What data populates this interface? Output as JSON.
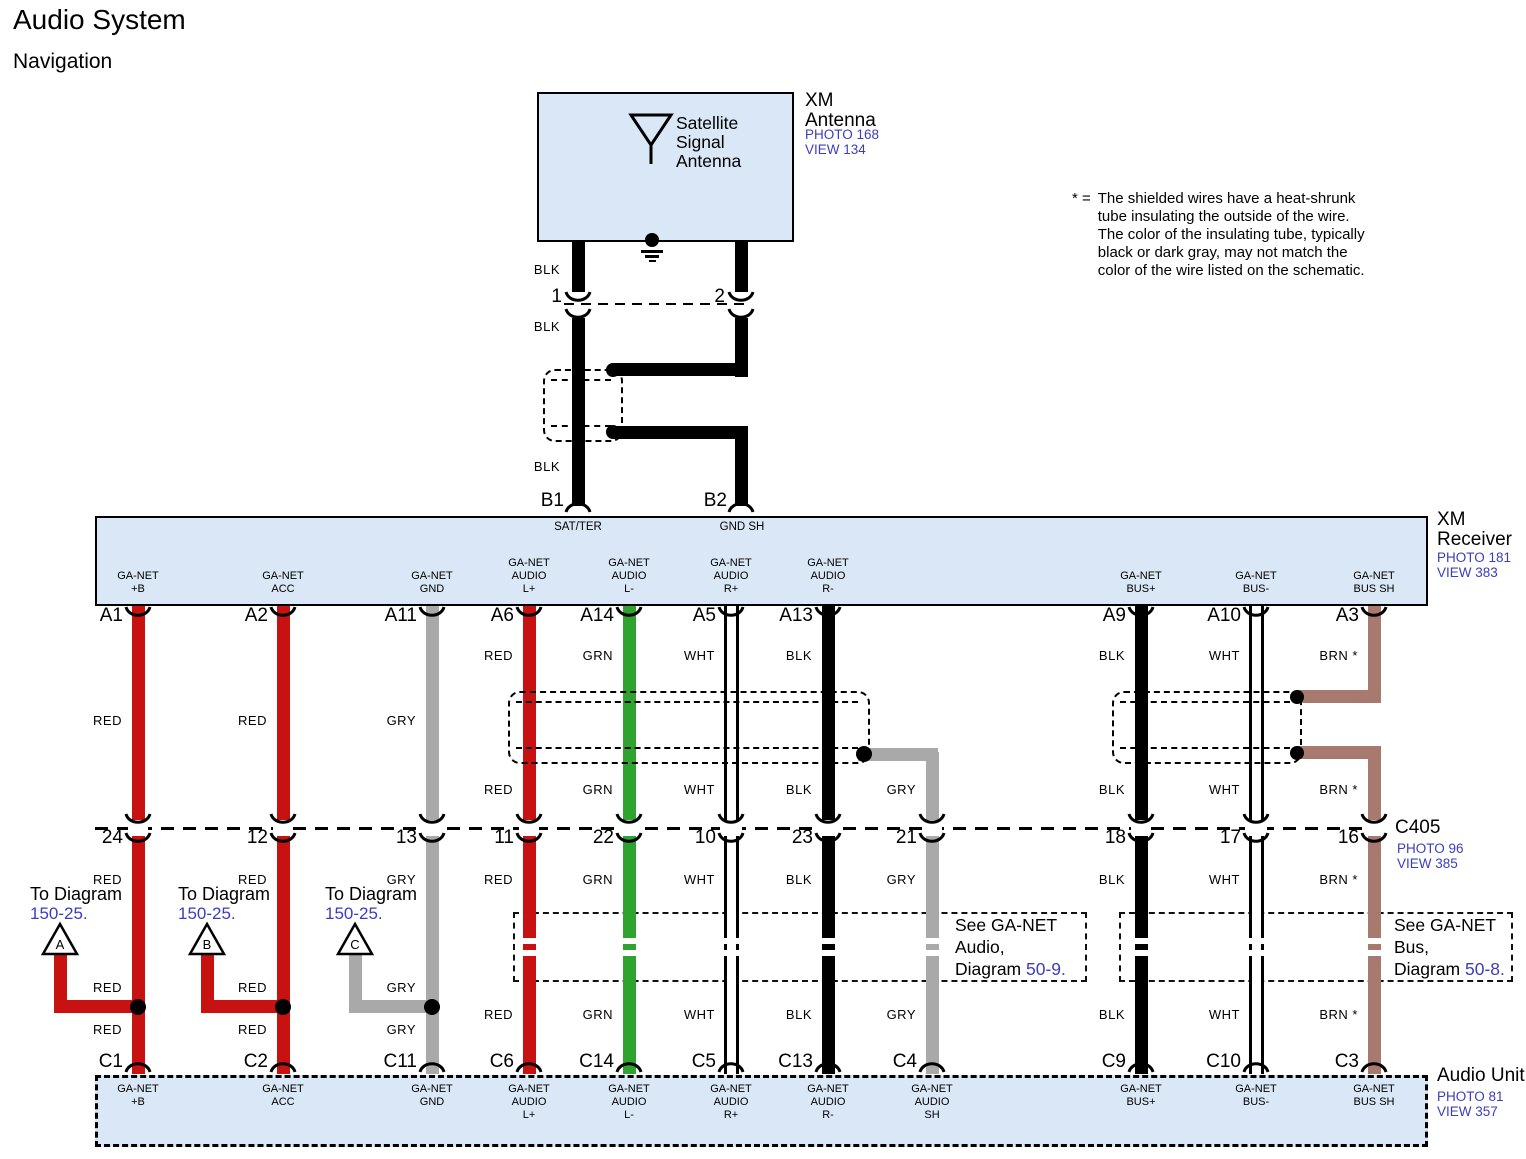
{
  "title": "Audio System",
  "subtitle": "Navigation",
  "note": {
    "prefix": "* =",
    "lines": [
      "The shielded wires have a heat-shrunk",
      "tube insulating the outside of the wire.",
      "The color of the insulating tube, typically",
      "black or dark gray, may not match the",
      "color of the wire listed on the schematic."
    ]
  },
  "palette": {
    "red": "#c81111",
    "green": "#2fa32f",
    "gray": "#a9a9a9",
    "black": "#000000",
    "white": "#ffffff",
    "brown": "#a7796f",
    "box_fill": "#d9e7f6",
    "ref_blue": "#3c3cc0"
  },
  "antenna": {
    "box_label": [
      "Satellite",
      "Signal",
      "Antenna"
    ],
    "title_lines": [
      "XM",
      "Antenna"
    ],
    "photo": "PHOTO 168",
    "view": "VIEW 134",
    "pin1": "1",
    "pin2": "2",
    "b1": "B1",
    "b2": "B2",
    "wire_label_1": "BLK",
    "wire_label_2": "BLK",
    "wire_label_3": "BLK"
  },
  "receiver": {
    "title_lines": [
      "XM",
      "Receiver"
    ],
    "photo": "PHOTO 181",
    "view": "VIEW 383",
    "sat_pin": "SAT/TER",
    "gnd_pin": "GND SH"
  },
  "c405": {
    "name": "C405",
    "photo": "PHOTO 96",
    "view": "VIEW 385"
  },
  "audio_unit": {
    "title": "Audio Unit",
    "photo": "PHOTO 81",
    "view": "VIEW 357"
  },
  "see_audio": {
    "line1": "See GA-NET",
    "line2": "Audio,",
    "line3_word": "Diagram",
    "line3_ref": "50-9."
  },
  "see_bus": {
    "line1": "See GA-NET",
    "line2": "Bus,",
    "line3_word": "Diagram",
    "line3_ref": "50-8."
  },
  "branches": [
    {
      "text": "To Diagram",
      "ref": "150-25.",
      "letter": "A",
      "text_x": 30,
      "tri_x": 60,
      "col_x": 138,
      "wire_color": "red",
      "labels": [
        {
          "t": "RED",
          "y": 988
        },
        {
          "t": "RED",
          "y": 1030
        }
      ]
    },
    {
      "text": "To Diagram",
      "ref": "150-25.",
      "letter": "B",
      "text_x": 178,
      "tri_x": 207,
      "col_x": 283,
      "wire_color": "red",
      "labels": [
        {
          "t": "RED",
          "y": 988
        },
        {
          "t": "RED",
          "y": 1030
        }
      ]
    },
    {
      "text": "To Diagram",
      "ref": "150-25.",
      "letter": "C",
      "text_x": 325,
      "tri_x": 355,
      "col_x": 432,
      "wire_color": "gray",
      "labels": [
        {
          "t": "GRY",
          "y": 988
        },
        {
          "t": "GRY",
          "y": 1030
        }
      ]
    }
  ],
  "columns": [
    {
      "x": 138,
      "color": "red",
      "kind": "full",
      "gaps": false,
      "a": "A1",
      "m": "24",
      "c": "C1",
      "receiver_pin": [
        "GA-NET",
        "+B"
      ],
      "unit_pin": [
        "GA-NET",
        "+B"
      ],
      "labels": [
        {
          "t": "RED",
          "y": 721
        },
        {
          "t": "RED",
          "y": 880
        }
      ]
    },
    {
      "x": 283,
      "color": "red",
      "kind": "full",
      "gaps": false,
      "a": "A2",
      "m": "12",
      "c": "C2",
      "receiver_pin": [
        "GA-NET",
        "ACC"
      ],
      "unit_pin": [
        "GA-NET",
        "ACC"
      ],
      "labels": [
        {
          "t": "RED",
          "y": 721
        },
        {
          "t": "RED",
          "y": 880
        }
      ]
    },
    {
      "x": 432,
      "color": "gray",
      "kind": "full",
      "gaps": false,
      "a": "A11",
      "m": "13",
      "c": "C11",
      "receiver_pin": [
        "GA-NET",
        "GND"
      ],
      "unit_pin": [
        "GA-NET",
        "GND"
      ],
      "labels": [
        {
          "t": "GRY",
          "y": 721
        },
        {
          "t": "GRY",
          "y": 880
        }
      ]
    },
    {
      "x": 529,
      "color": "red",
      "kind": "full",
      "gaps": true,
      "a": "A6",
      "m": "11",
      "c": "C6",
      "receiver_pin": [
        "GA-NET",
        "AUDIO",
        "L+"
      ],
      "unit_pin": [
        "GA-NET",
        "AUDIO",
        "L+"
      ],
      "labels": [
        {
          "t": "RED",
          "y": 656
        },
        {
          "t": "RED",
          "y": 790
        },
        {
          "t": "RED",
          "y": 880
        },
        {
          "t": "RED",
          "y": 1015
        }
      ]
    },
    {
      "x": 629,
      "color": "green",
      "kind": "full",
      "gaps": true,
      "a": "A14",
      "m": "22",
      "c": "C14",
      "receiver_pin": [
        "GA-NET",
        "AUDIO",
        "L-"
      ],
      "unit_pin": [
        "GA-NET",
        "AUDIO",
        "L-"
      ],
      "labels": [
        {
          "t": "GRN",
          "y": 656
        },
        {
          "t": "GRN",
          "y": 790
        },
        {
          "t": "GRN",
          "y": 880
        },
        {
          "t": "GRN",
          "y": 1015
        }
      ]
    },
    {
      "x": 731,
      "color": "white",
      "kind": "full",
      "gaps": true,
      "a": "A5",
      "m": "10",
      "c": "C5",
      "receiver_pin": [
        "GA-NET",
        "AUDIO",
        "R+"
      ],
      "unit_pin": [
        "GA-NET",
        "AUDIO",
        "R+"
      ],
      "labels": [
        {
          "t": "WHT",
          "y": 656
        },
        {
          "t": "WHT",
          "y": 790
        },
        {
          "t": "WHT",
          "y": 880
        },
        {
          "t": "WHT",
          "y": 1015
        }
      ]
    },
    {
      "x": 828,
      "color": "black",
      "kind": "full",
      "gaps": true,
      "a": "A13",
      "m": "23",
      "c": "C13",
      "receiver_pin": [
        "GA-NET",
        "AUDIO",
        "R-"
      ],
      "unit_pin": [
        "GA-NET",
        "AUDIO",
        "R-"
      ],
      "labels": [
        {
          "t": "BLK",
          "y": 656
        },
        {
          "t": "BLK",
          "y": 790
        },
        {
          "t": "BLK",
          "y": 880
        },
        {
          "t": "BLK",
          "y": 1015
        }
      ]
    },
    {
      "x": 932,
      "color": "gray",
      "kind": "tap",
      "gaps": true,
      "a": null,
      "m": "21",
      "c": "C4",
      "receiver_pin": null,
      "unit_pin": [
        "GA-NET",
        "AUDIO",
        "SH"
      ],
      "labels": [
        {
          "t": "GRY",
          "y": 790
        },
        {
          "t": "GRY",
          "y": 880
        },
        {
          "t": "GRY",
          "y": 1015
        }
      ]
    },
    {
      "x": 1141,
      "color": "black",
      "kind": "full",
      "gaps": true,
      "a": "A9",
      "m": "18",
      "c": "C9",
      "receiver_pin": [
        "GA-NET",
        "BUS+"
      ],
      "unit_pin": [
        "GA-NET",
        "BUS+"
      ],
      "labels": [
        {
          "t": "BLK",
          "y": 656
        },
        {
          "t": "BLK",
          "y": 790
        },
        {
          "t": "BLK",
          "y": 880
        },
        {
          "t": "BLK",
          "y": 1015
        }
      ]
    },
    {
      "x": 1256,
      "color": "white",
      "kind": "full",
      "gaps": true,
      "a": "A10",
      "m": "17",
      "c": "C10",
      "receiver_pin": [
        "GA-NET",
        "BUS-"
      ],
      "unit_pin": [
        "GA-NET",
        "BUS-"
      ],
      "labels": [
        {
          "t": "WHT",
          "y": 656
        },
        {
          "t": "WHT",
          "y": 790
        },
        {
          "t": "WHT",
          "y": 880
        },
        {
          "t": "WHT",
          "y": 1015
        }
      ]
    },
    {
      "x": 1374,
      "color": "brown",
      "kind": "split",
      "gaps": true,
      "a": "A3",
      "m": "16",
      "c": "C3",
      "receiver_pin": [
        "GA-NET",
        "BUS SH"
      ],
      "unit_pin": [
        "GA-NET",
        "BUS SH"
      ],
      "labels": [
        {
          "t": "BRN *",
          "y": 656
        },
        {
          "t": "BRN *",
          "y": 790
        },
        {
          "t": "BRN *",
          "y": 880
        },
        {
          "t": "BRN *",
          "y": 1015
        }
      ]
    }
  ]
}
